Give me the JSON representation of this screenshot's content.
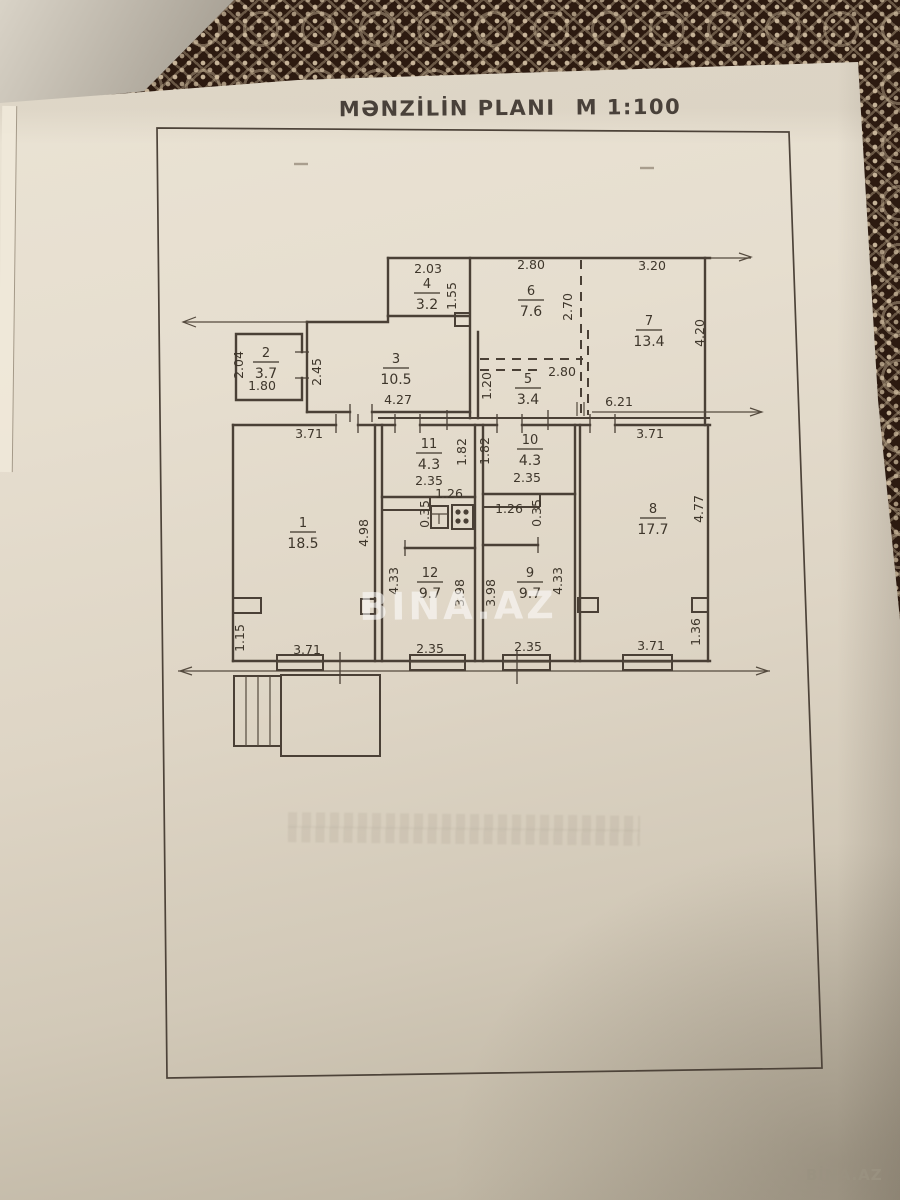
{
  "document": {
    "title": "MƏNZİLİN PLANI",
    "scale": "M 1:100",
    "watermark_center": "BINA.AZ",
    "watermark_corner": "BİNA.AZ"
  },
  "floor_plan": {
    "type": "apartment-plan",
    "rooms": [
      {
        "num": "1",
        "area": "18.5",
        "x": 303,
        "y": 532
      },
      {
        "num": "2",
        "area": "3.7",
        "x": 266,
        "y": 362
      },
      {
        "num": "3",
        "area": "10.5",
        "x": 396,
        "y": 368
      },
      {
        "num": "4",
        "area": "3.2",
        "x": 427,
        "y": 293
      },
      {
        "num": "5",
        "area": "3.4",
        "x": 528,
        "y": 388
      },
      {
        "num": "6",
        "area": "7.6",
        "x": 531,
        "y": 300
      },
      {
        "num": "7",
        "area": "13.4",
        "x": 649,
        "y": 330
      },
      {
        "num": "8",
        "area": "17.7",
        "x": 653,
        "y": 518
      },
      {
        "num": "9",
        "area": "9.7",
        "x": 530,
        "y": 582
      },
      {
        "num": "10",
        "area": "4.3",
        "x": 530,
        "y": 449
      },
      {
        "num": "11",
        "area": "4.3",
        "x": 429,
        "y": 453
      },
      {
        "num": "12",
        "area": "9.7",
        "x": 430,
        "y": 582
      }
    ],
    "dimensions": [
      {
        "text": "2.03",
        "x": 428,
        "y": 273,
        "rot": 0
      },
      {
        "text": "2.80",
        "x": 531,
        "y": 269,
        "rot": 0
      },
      {
        "text": "3.20",
        "x": 652,
        "y": 270,
        "rot": 0
      },
      {
        "text": "1.55",
        "x": 456,
        "y": 296,
        "rot": -90
      },
      {
        "text": "2.70",
        "x": 572,
        "y": 307,
        "rot": -90
      },
      {
        "text": "4.20",
        "x": 704,
        "y": 333,
        "rot": -90
      },
      {
        "text": "2.04",
        "x": 243,
        "y": 365,
        "rot": -90
      },
      {
        "text": "2.45",
        "x": 321,
        "y": 372,
        "rot": -90
      },
      {
        "text": "1.80",
        "x": 262,
        "y": 390,
        "rot": 0
      },
      {
        "text": "1.20",
        "x": 491,
        "y": 386,
        "rot": -90
      },
      {
        "text": "2.80",
        "x": 562,
        "y": 376,
        "rot": 0
      },
      {
        "text": "6.21",
        "x": 619,
        "y": 406,
        "rot": 0
      },
      {
        "text": "4.27",
        "x": 398,
        "y": 404,
        "rot": 0
      },
      {
        "text": "3.71",
        "x": 309,
        "y": 438,
        "rot": 0
      },
      {
        "text": "3.71",
        "x": 650,
        "y": 438,
        "rot": 0
      },
      {
        "text": "1.82",
        "x": 466,
        "y": 452,
        "rot": -90
      },
      {
        "text": "1.82",
        "x": 489,
        "y": 451,
        "rot": -90
      },
      {
        "text": "2.35",
        "x": 429,
        "y": 485,
        "rot": 0
      },
      {
        "text": "2.35",
        "x": 527,
        "y": 482,
        "rot": 0
      },
      {
        "text": "1.26",
        "x": 449,
        "y": 498,
        "rot": 0
      },
      {
        "text": "1.26",
        "x": 509,
        "y": 513,
        "rot": 0
      },
      {
        "text": "0.35",
        "x": 429,
        "y": 514,
        "rot": -90
      },
      {
        "text": "0.35",
        "x": 541,
        "y": 513,
        "rot": -90
      },
      {
        "text": "4.98",
        "x": 368,
        "y": 533,
        "rot": -90
      },
      {
        "text": "4.33",
        "x": 398,
        "y": 581,
        "rot": -90
      },
      {
        "text": "3.98",
        "x": 464,
        "y": 593,
        "rot": -90
      },
      {
        "text": "3.98",
        "x": 495,
        "y": 593,
        "rot": -90
      },
      {
        "text": "4.33",
        "x": 562,
        "y": 581,
        "rot": -90
      },
      {
        "text": "4.77",
        "x": 703,
        "y": 509,
        "rot": -90
      },
      {
        "text": "1.15",
        "x": 244,
        "y": 638,
        "rot": -90
      },
      {
        "text": "1.36",
        "x": 700,
        "y": 632,
        "rot": -90
      },
      {
        "text": "3.71",
        "x": 307,
        "y": 654,
        "rot": 0
      },
      {
        "text": "2.35",
        "x": 430,
        "y": 653,
        "rot": 0
      },
      {
        "text": "2.35",
        "x": 528,
        "y": 651,
        "rot": 0
      },
      {
        "text": "3.71",
        "x": 651,
        "y": 650,
        "rot": 0
      }
    ],
    "fixtures": [
      {
        "name": "sink-icon"
      },
      {
        "name": "stove-icon"
      }
    ]
  }
}
